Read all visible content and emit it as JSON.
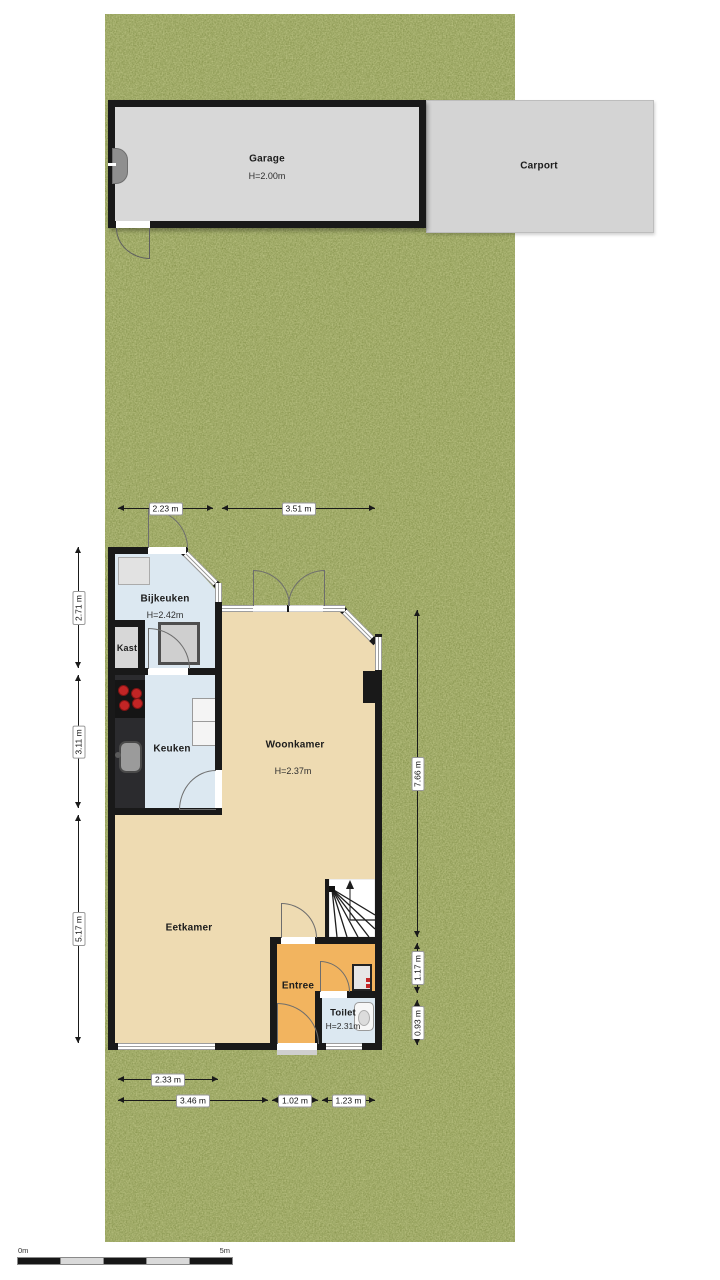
{
  "outbuildings": {
    "garage": {
      "name": "Garage",
      "height": "H=2.00m"
    },
    "carport": {
      "name": "Carport"
    }
  },
  "rooms": {
    "bijkeuken": {
      "name": "Bijkeuken",
      "height": "H=2.42m"
    },
    "kast": {
      "name": "Kast"
    },
    "keuken": {
      "name": "Keuken"
    },
    "woonkamer": {
      "name": "Woonkamer",
      "height": "H=2.37m"
    },
    "eetkamer": {
      "name": "Eetkamer"
    },
    "entree": {
      "name": "Entree"
    },
    "toilet": {
      "name": "Toilet",
      "height": "H=2.31m"
    }
  },
  "dimensions": {
    "top": [
      "2.23 m",
      "3.51 m"
    ],
    "left": [
      "2.71 m",
      "3.11 m",
      "5.17 m"
    ],
    "right": [
      "7.66 m",
      "1.17 m",
      "0.93 m"
    ],
    "bottom_row1": [
      "2.33 m"
    ],
    "bottom_row2": [
      "3.46 m",
      "1.02 m",
      "1.23 m"
    ]
  },
  "scale_bar": {
    "start": "0m",
    "end": "5m"
  },
  "colors": {
    "grass": "#75843b",
    "wall": "#191919",
    "floor_living": "#eedbb2",
    "floor_wet": "#dce8f1",
    "floor_entry": "#f2b45f",
    "outbuilding": "#d8d8d8"
  }
}
